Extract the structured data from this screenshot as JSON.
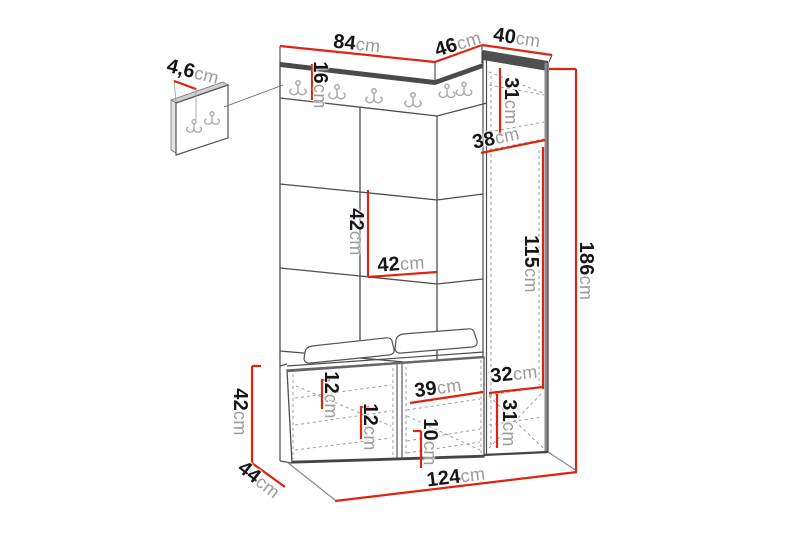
{
  "colors": {
    "dimension_line": "#df2310",
    "number_text": "#161616",
    "unit_text": "#9b9b9b",
    "furniture_line": "#4d4d4d",
    "dashed_line": "#9c9c9c",
    "hook_gray": "#ababab"
  },
  "diagram": {
    "unit_suffix": "cm",
    "dimensions": [
      {
        "id": "panel-thickness",
        "value": "4,6",
        "x": 193,
        "y": 72,
        "rot": 14,
        "line": [
          174,
          81,
          196,
          89
        ]
      },
      {
        "id": "top-width-left",
        "value": "84",
        "x": 357,
        "y": 44,
        "rot": 6,
        "line": [
          280,
          46,
          435,
          62
        ]
      },
      {
        "id": "top-width-corner",
        "value": "46",
        "x": 458,
        "y": 44,
        "rot": -17,
        "line": [
          435,
          62,
          482,
          45
        ]
      },
      {
        "id": "top-width-right",
        "value": "40",
        "x": 517,
        "y": 38,
        "rot": 8,
        "line": [
          482,
          45,
          552,
          55
        ]
      },
      {
        "id": "hook-rail-height",
        "value": "16",
        "x": 320,
        "y": 85,
        "rot": 90,
        "line": [
          312,
          64,
          312,
          100
        ]
      },
      {
        "id": "cabinet-top-section",
        "value": "31",
        "x": 511,
        "y": 101,
        "rot": 90,
        "line": [
          500,
          68,
          500,
          136
        ]
      },
      {
        "id": "cabinet-shelf",
        "value": "38",
        "x": 496,
        "y": 138,
        "rot": -12,
        "line": [
          481,
          153,
          545,
          140
        ]
      },
      {
        "id": "panel-tile-height",
        "value": "42",
        "x": 356,
        "y": 232,
        "rot": 90,
        "line": [
          368,
          190,
          368,
          277
        ]
      },
      {
        "id": "panel-tile-width",
        "value": "42",
        "x": 401,
        "y": 264,
        "rot": -4,
        "line": [
          368,
          277,
          437,
          272
        ]
      },
      {
        "id": "cabinet-middle-section",
        "value": "115",
        "x": 531,
        "y": 264,
        "rot": 90,
        "line": [
          543,
          147,
          543,
          389
        ]
      },
      {
        "id": "total-height",
        "value": "186",
        "x": 586,
        "y": 271,
        "rot": 90,
        "line": [
          576,
          69,
          576,
          471
        ],
        "line2": [
          549,
          69,
          576,
          69
        ]
      },
      {
        "id": "cabinet-lower-section",
        "value": "32",
        "x": 514,
        "y": 374,
        "rot": -6,
        "line": [
          489,
          393,
          543,
          387
        ]
      },
      {
        "id": "cabinet-bottom-section",
        "value": "31",
        "x": 509,
        "y": 423,
        "rot": 90,
        "line": [
          497,
          394,
          497,
          448
        ]
      },
      {
        "id": "bench-shelf-left",
        "value": "12",
        "x": 331,
        "y": 395,
        "rot": 90,
        "line": [
          322,
          379,
          322,
          409
        ],
        "line2": [
          322,
          380,
          330,
          380
        ]
      },
      {
        "id": "bench-shelf-middle",
        "value": "12",
        "x": 370,
        "y": 427,
        "rot": 90,
        "line": [
          361,
          406,
          361,
          439
        ],
        "line2": [
          361,
          407,
          369,
          407
        ]
      },
      {
        "id": "bench-door-width",
        "value": "39",
        "x": 438,
        "y": 388,
        "rot": -8,
        "line": [
          410,
          403,
          483,
          392
        ]
      },
      {
        "id": "bench-shelf-right",
        "value": "10",
        "x": 430,
        "y": 442,
        "rot": 90,
        "line": [
          421,
          431,
          421,
          468
        ],
        "line2": [
          413,
          431,
          421,
          431
        ]
      },
      {
        "id": "bench-height",
        "value": "42",
        "x": 240,
        "y": 412,
        "rot": 90,
        "line": [
          252,
          366,
          252,
          463
        ],
        "line2": [
          252,
          366,
          261,
          366
        ]
      },
      {
        "id": "bench-depth",
        "value": "44",
        "x": 259,
        "y": 480,
        "rot": 38,
        "line": [
          252,
          463,
          285,
          487
        ]
      },
      {
        "id": "total-width",
        "value": "124",
        "x": 456,
        "y": 477,
        "rot": -7,
        "line": [
          335,
          501,
          577,
          472
        ]
      }
    ]
  }
}
